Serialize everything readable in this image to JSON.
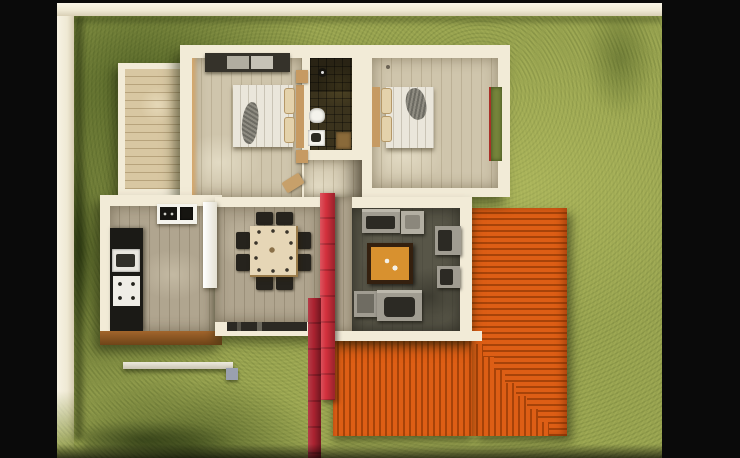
{
  "scene": {
    "type": "3d-floor-plan-render",
    "view": "top-down aerial render of a single-storey house on a grass lot, letterboxed with black side bars",
    "palette": {
      "bg_black": "#0a0a0a",
      "fence_cream": "#efe9d4",
      "grass_mid": "#97a24f",
      "wall_cream": "#f2ebd7",
      "deck_wood": "#d8c7a2",
      "floor_bedroom": "#cfc5ac",
      "floor_kitchen": "#b0a58f",
      "interior_tan": "#d8a86a",
      "bath_tile": "#3b331d",
      "fixture_white": "#f4f3ec",
      "appliance_black": "#1b1a16",
      "sofa_gray": "#a09c91",
      "sofa_dark": "#2c2a24",
      "bed_linen": "#eae6db",
      "blanket_gray": "#8f8c82",
      "headboard_wood": "#c69a62",
      "table_cream": "#e6d6b6",
      "chair_dark": "#26231d",
      "living_floor": "#585648",
      "roof_orange": "#dd5e15",
      "roof_orange_dark": "#a64309",
      "red_accent": "#d4303d",
      "red_accent_dark": "#aa2230",
      "coffee_table_top": "#d8912f",
      "coffee_table_frame": "#34200f",
      "window_green": "#76853b",
      "door_tan": "#c7a06a",
      "pad_gray": "#9aa0af"
    },
    "rooms": [
      {
        "name": "bedroom-1",
        "position": "top-left",
        "furniture": [
          "wardrobe",
          "double-bed",
          "two-bedside-tables"
        ]
      },
      {
        "name": "bathroom",
        "position": "top-center",
        "furniture": [
          "shower",
          "toilet",
          "washbasin",
          "wood-vanity"
        ]
      },
      {
        "name": "bedroom-2",
        "position": "top-right",
        "furniture": [
          "double-bed",
          "garden-window"
        ]
      },
      {
        "name": "kitchen",
        "position": "bottom-left",
        "furniture": [
          "sink-unit",
          "cooktop",
          "oven",
          "refrigerator",
          "counter"
        ]
      },
      {
        "name": "dining-room",
        "position": "bottom-center",
        "furniture": [
          "square-table",
          "eight-chairs",
          "sideboard"
        ]
      },
      {
        "name": "living-room",
        "position": "bottom-right",
        "furniture": [
          "sofa",
          "second-sofa",
          "two-armchairs",
          "armchair",
          "coffee-table",
          "side-table"
        ]
      }
    ],
    "exterior": [
      "white-perimeter-wall",
      "wood-deck",
      "orange-corrugated-roof-terrace",
      "roof-steps",
      "red-feature-wall",
      "low-garden-wall",
      "entry-pad",
      "lawn"
    ]
  }
}
